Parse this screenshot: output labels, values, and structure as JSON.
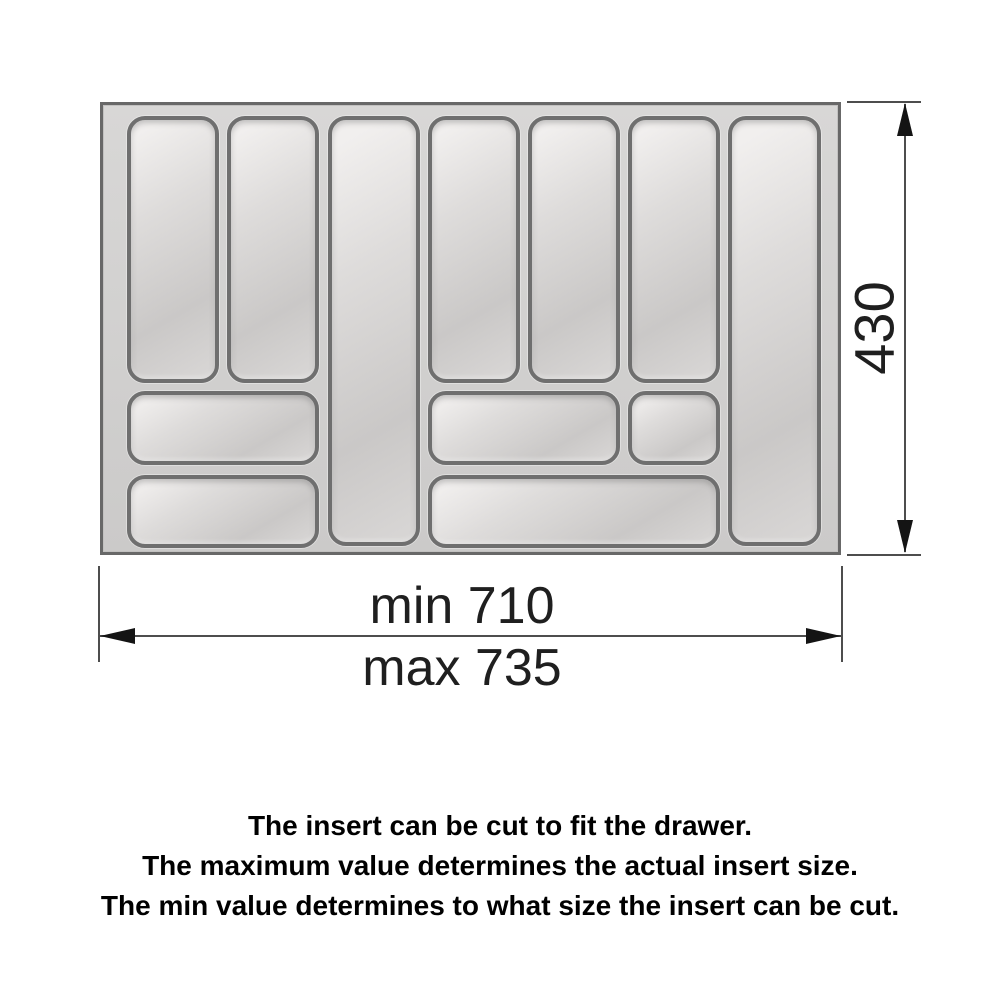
{
  "diagram": {
    "type": "dimension-drawing",
    "subject": "cutlery-tray-drawer-insert",
    "tray": {
      "compartments": [
        {
          "id": "slot-1",
          "x": 24,
          "y": 11,
          "w": 92,
          "h": 267
        },
        {
          "id": "slot-2",
          "x": 124,
          "y": 11,
          "w": 92,
          "h": 267
        },
        {
          "id": "slot-3-tall",
          "x": 225,
          "y": 11,
          "w": 92,
          "h": 430
        },
        {
          "id": "slot-4",
          "x": 325,
          "y": 11,
          "w": 92,
          "h": 267
        },
        {
          "id": "slot-5",
          "x": 425,
          "y": 11,
          "w": 92,
          "h": 267
        },
        {
          "id": "slot-6",
          "x": 525,
          "y": 11,
          "w": 92,
          "h": 267
        },
        {
          "id": "slot-7-tall",
          "x": 625,
          "y": 11,
          "w": 93,
          "h": 430
        },
        {
          "id": "box-mid-left",
          "x": 24,
          "y": 286,
          "w": 192,
          "h": 74
        },
        {
          "id": "box-mid-center",
          "x": 325,
          "y": 286,
          "w": 192,
          "h": 74
        },
        {
          "id": "box-mid-small",
          "x": 525,
          "y": 286,
          "w": 92,
          "h": 74
        },
        {
          "id": "box-bottom-left",
          "x": 24,
          "y": 370,
          "w": 192,
          "h": 73
        },
        {
          "id": "box-bottom-long",
          "x": 325,
          "y": 370,
          "w": 292,
          "h": 73
        }
      ]
    },
    "dimensions": {
      "height_label": "430",
      "width_min_label": "min 710",
      "width_max_label": "max 735"
    },
    "colors": {
      "tray_surface_light": "#d8d7d6",
      "tray_surface_dark": "#cbcac9",
      "tray_border": "#686868",
      "compartment_border": "#6f6f6f",
      "compartment_fill_light": "#f1efee",
      "compartment_fill_dark": "#cac8c7",
      "dimension_line": "#4d4d4d",
      "arrow": "#141414",
      "text": "#000000"
    }
  },
  "notes": {
    "line1": "The insert can be cut to fit the drawer.",
    "line2": "The maximum value determines the actual insert size.",
    "line3": "The min value determines to what size the insert can be cut."
  }
}
